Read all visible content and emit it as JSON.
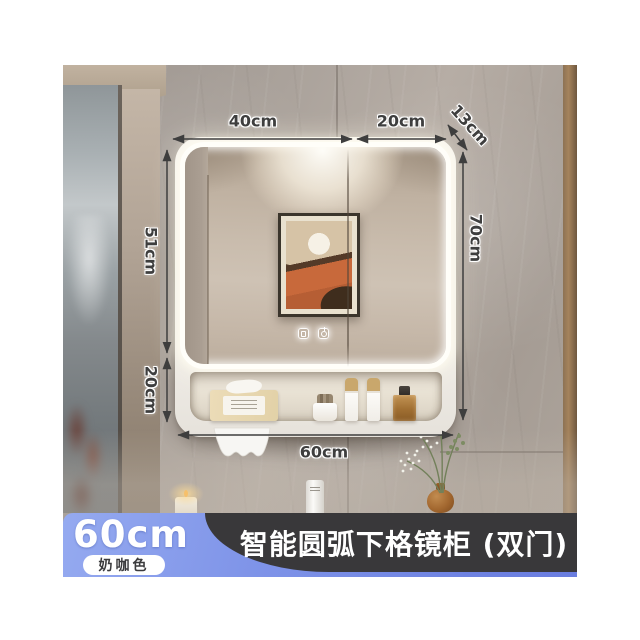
{
  "product": {
    "title": "智能圆弧下格镜柜 (双门)",
    "size_label": "60cm",
    "color_label": "奶咖色"
  },
  "dimensions": {
    "top_width_left": "40cm",
    "top_width_right": "20cm",
    "depth": "13cm",
    "mirror_height": "51cm",
    "shelf_height": "20cm",
    "total_height": "70cm",
    "total_width": "60cm"
  },
  "colors": {
    "badge_blue": "#7e93e8",
    "banner_dark": "#39383a",
    "led_white": "#ffffff",
    "dimension_ink": "#3e3e3e"
  },
  "icons": [
    "defog-icon",
    "power-icon"
  ]
}
